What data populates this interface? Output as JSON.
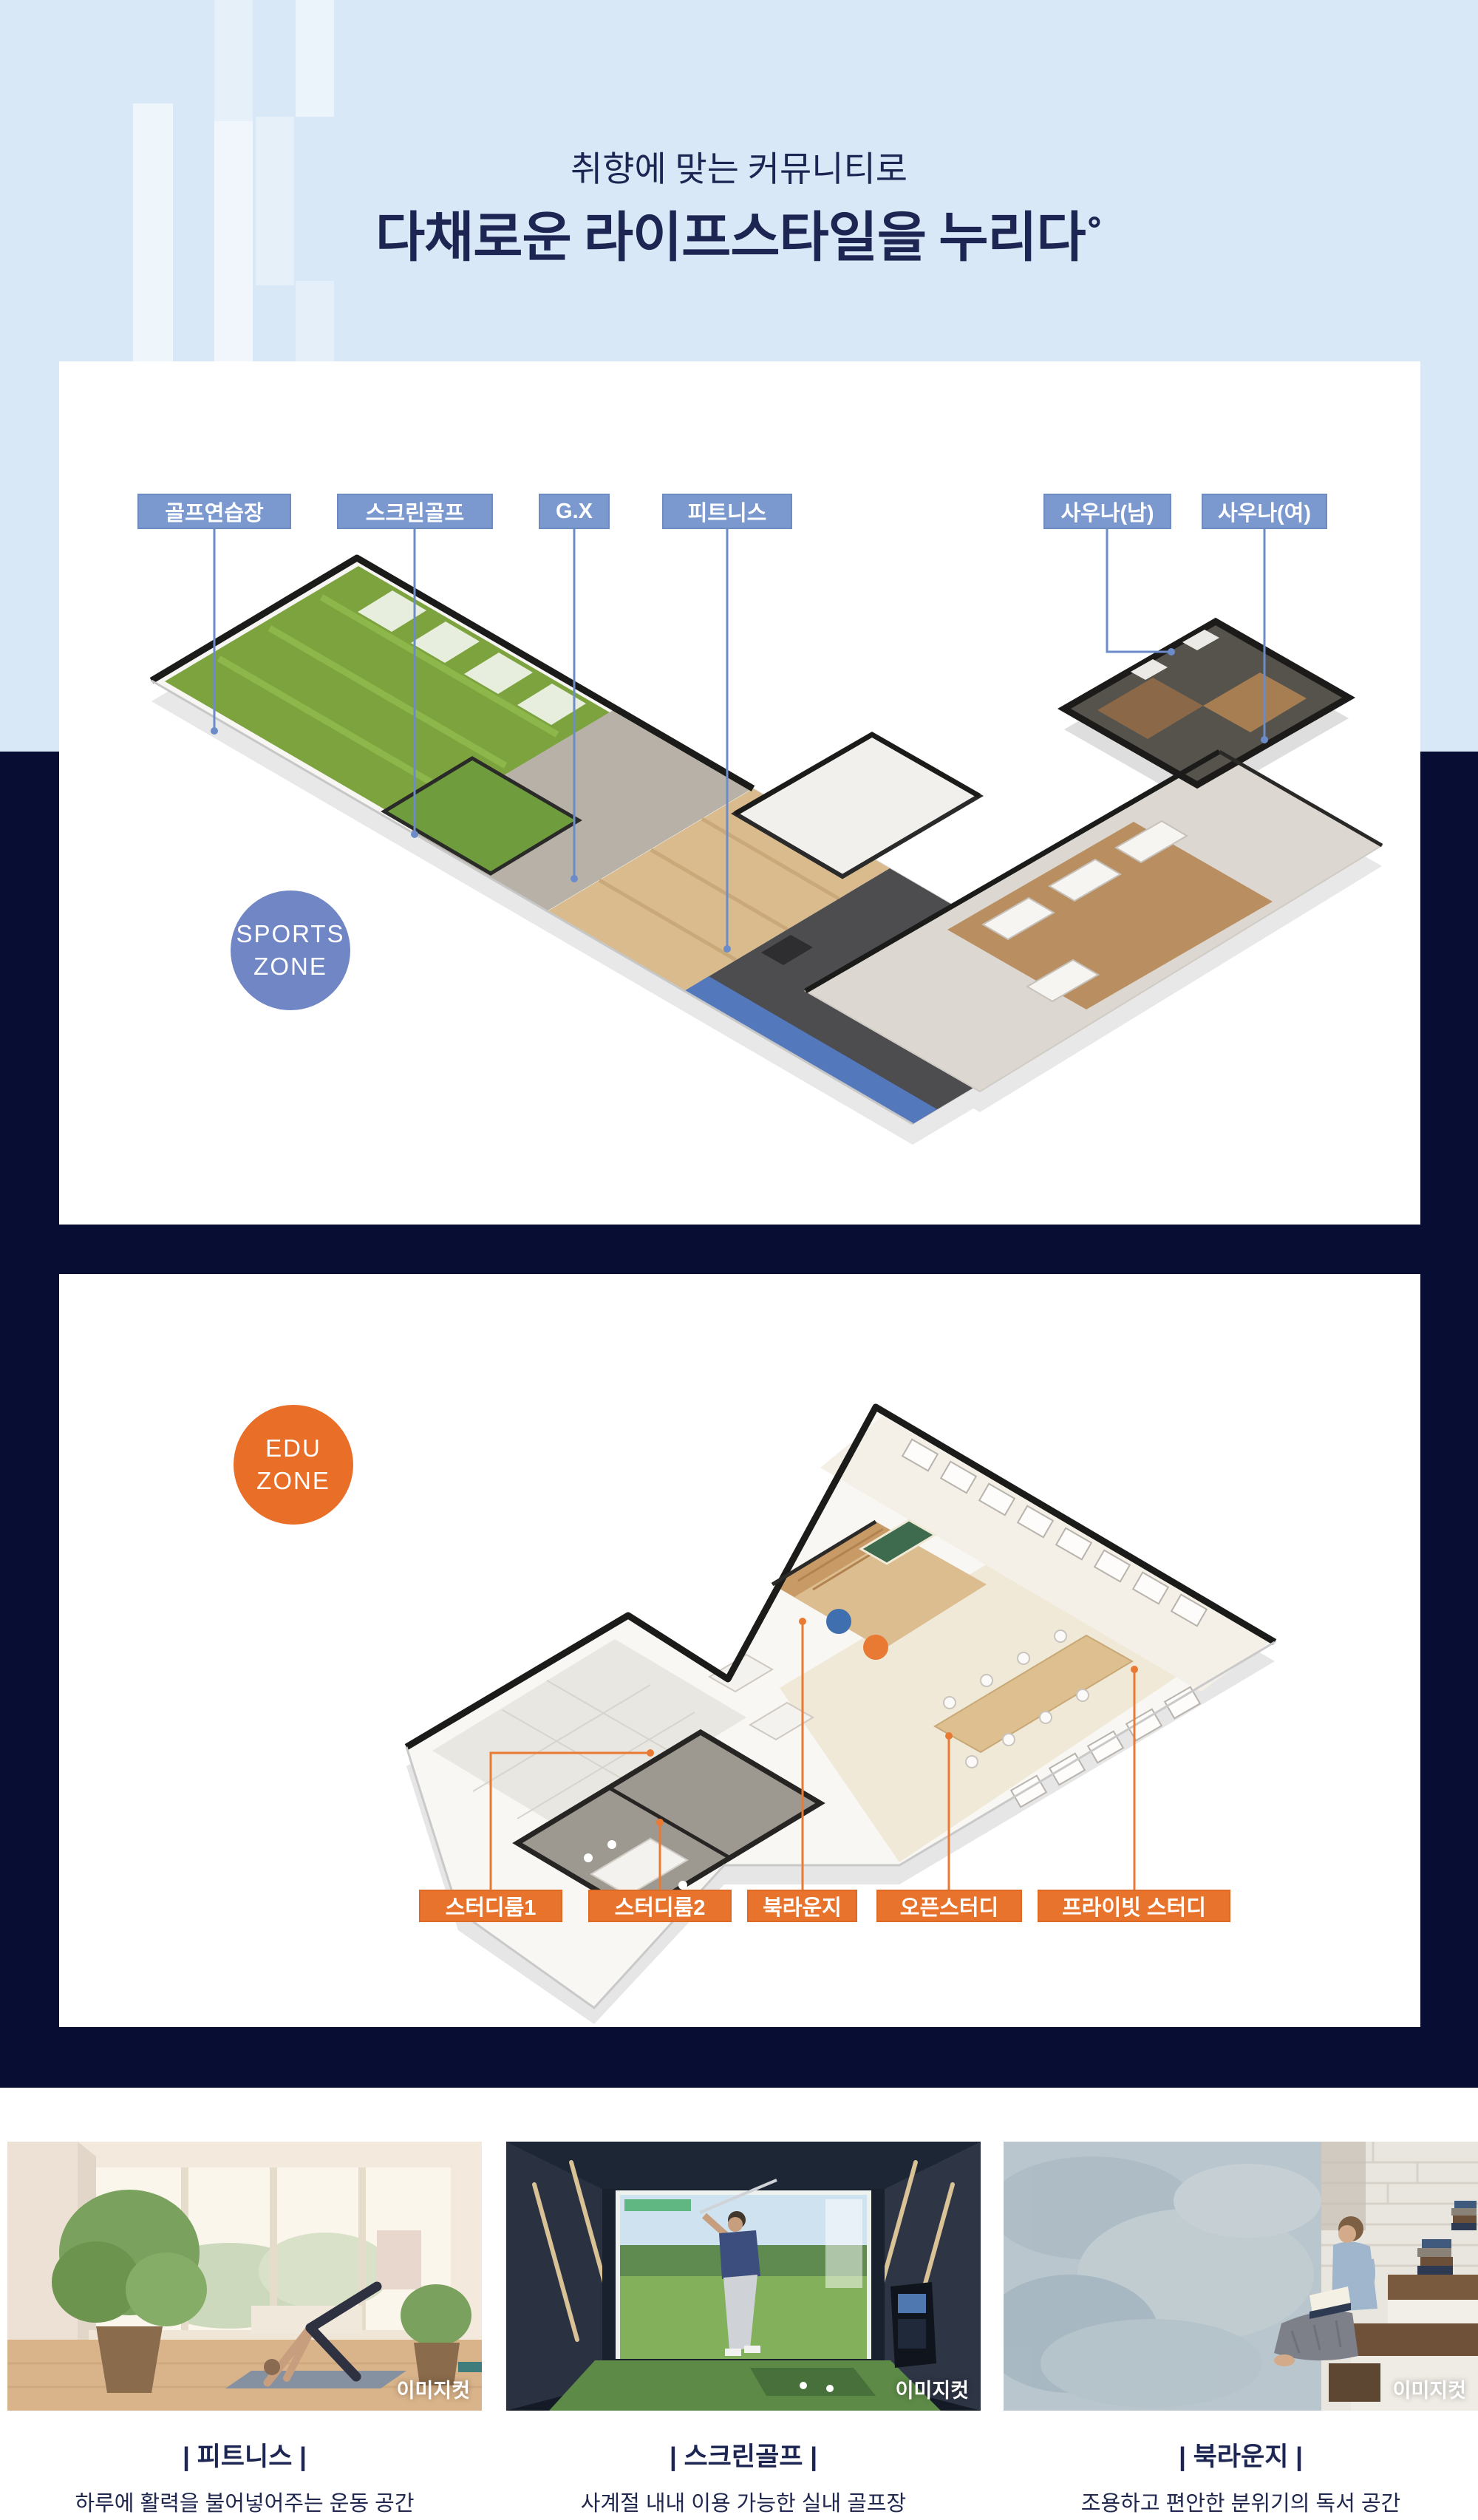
{
  "header": {
    "subtitle": "취향에 맞는 커뮤니티로",
    "title": "다채로운 라이프스타일을 누리다˚"
  },
  "sports_zone": {
    "badge_line1": "SPORTS",
    "badge_line2": "ZONE",
    "labels": [
      "골프연습장",
      "스크린골프",
      "G.X",
      "피트니스",
      "사우나(남)",
      "사우나(여)"
    ]
  },
  "edu_zone": {
    "badge_line1": "EDU",
    "badge_line2": "ZONE",
    "labels": [
      "스터디룸1",
      "스터디룸2",
      "북라운지",
      "오픈스터디",
      "프라이빗 스터디"
    ]
  },
  "gallery": [
    {
      "caption": "| 피트니스 |",
      "description": "하루에 활력을 불어넣어주는 운동 공간",
      "watermark": "이미지컷"
    },
    {
      "caption": "| 스크린골프 |",
      "description": "사계절 내내 이용 가능한 실내 골프장",
      "watermark": "이미지컷"
    },
    {
      "caption": "| 북라운지 |",
      "description": "조용하고 편안한 분위기의 독서 공간",
      "watermark": "이미지컷"
    }
  ],
  "colors": {
    "header_background": "#d9e8f6",
    "navy_background": "#070d33",
    "title_text": "#1d2553",
    "sports_label_blue": "#7b99cf",
    "sports_badge_blue": "#7187c5",
    "edu_accent_orange": "#e8732c",
    "leader_line_blue": "#6b8cc9",
    "leader_line_orange": "#e87a33"
  }
}
